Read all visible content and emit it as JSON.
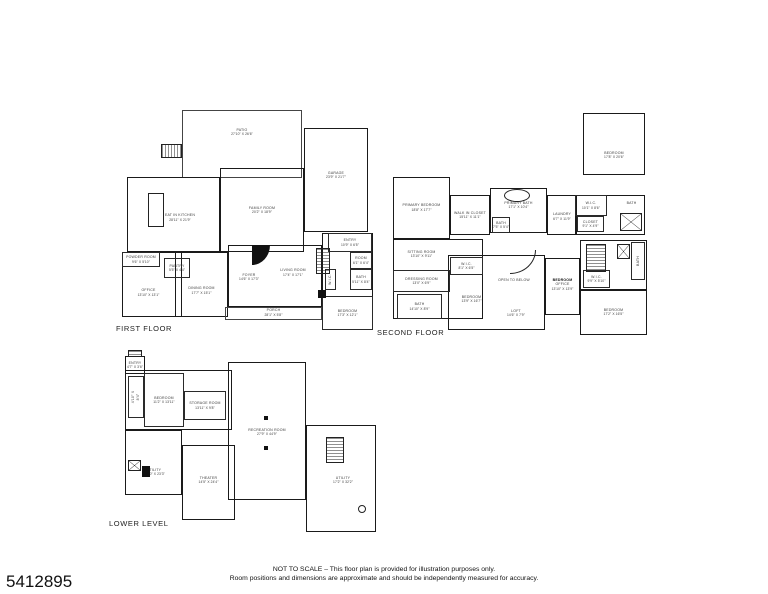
{
  "listing_id": "5412895",
  "disclaimer": {
    "line1": "NOT TO SCALE – This floor plan is provided for illustration purposes only.",
    "line2": "Room positions and dimensions are approximate and should be independently measured for accuracy."
  },
  "colors": {
    "wall": "#1a1a1a",
    "background": "#ffffff",
    "text": "#3a3a3a"
  },
  "floors": [
    {
      "name": "FIRST FLOOR",
      "outline": [
        {
          "box": [
            182,
            110,
            120,
            68
          ],
          "thin": true
        },
        {
          "box": [
            220,
            168,
            84,
            84
          ]
        },
        {
          "box": [
            304,
            128,
            64,
            104
          ]
        },
        {
          "box": [
            127,
            177,
            93,
            75
          ]
        },
        {
          "box": [
            122,
            252,
            60,
            65
          ]
        },
        {
          "box": [
            175,
            252,
            53,
            65
          ]
        },
        {
          "box": [
            228,
            245,
            94,
            62
          ]
        },
        {
          "box": [
            322,
            233,
            51,
            97
          ]
        },
        {
          "box": [
            225,
            307,
            97,
            13
          ],
          "thin": true
        }
      ],
      "rooms": [
        {
          "label": "PATIO",
          "dims": "27'10\" X 26'6\"",
          "box": [
            182,
            112,
            120,
            40
          ],
          "wall": "none"
        },
        {
          "label": "FAMILY ROOM",
          "dims": "20'2\" X 18'9\"",
          "box": [
            220,
            168,
            84,
            84
          ],
          "wall": "none"
        },
        {
          "label": "GARAGE",
          "dims": "23'9\" X 21'7\"",
          "box": [
            304,
            140,
            64,
            70
          ],
          "wall": "none"
        },
        {
          "label": "EAT IN KITCHEN",
          "dims": "28'11\" X 21'9\"",
          "box": [
            140,
            190,
            80,
            55
          ],
          "wall": "none"
        },
        {
          "label": "POWDER ROOM",
          "dims": "9'6\" X 5'10\"",
          "box": [
            122,
            252,
            38,
            15
          ],
          "wall": "thin"
        },
        {
          "label": "PANTRY",
          "dims": "5'5\" X 4'4\"",
          "box": [
            164,
            258,
            26,
            20
          ],
          "wall": "thin"
        },
        {
          "label": "OFFICE",
          "dims": "13'10\" X 13'1\"",
          "box": [
            122,
            268,
            53,
            49
          ],
          "wall": "none"
        },
        {
          "label": "DINING ROOM",
          "dims": "17'7\" X 15'1\"",
          "box": [
            175,
            268,
            53,
            45
          ],
          "wall": "none"
        },
        {
          "label": "FOYER",
          "dims": "14'6\" X 17'3\"",
          "box": [
            228,
            252,
            42,
            50
          ],
          "wall": "none"
        },
        {
          "label": "LIVING ROOM",
          "dims": "17'4\" X 17'1\"",
          "box": [
            270,
            245,
            46,
            55
          ],
          "wall": "none"
        },
        {
          "label": "PORCH",
          "dims": "28'1\" X 5'8\"",
          "box": [
            225,
            305,
            97,
            15
          ],
          "wall": "none"
        },
        {
          "label": "ENTRY",
          "dims": "10'9\" X 6'5\"",
          "box": [
            328,
            233,
            44,
            19
          ],
          "wall": "thin"
        },
        {
          "label": "ROOM",
          "dims": "6'1\" X 6'4\"",
          "box": [
            350,
            252,
            22,
            17
          ],
          "wall": "thin"
        },
        {
          "label": "BATH",
          "dims": "5'11\" X 8'4\"",
          "box": [
            350,
            269,
            22,
            21
          ],
          "wall": "thin"
        },
        {
          "id": "wic-hall",
          "label": "W.I.C.",
          "box": [
            325,
            269,
            11,
            21
          ],
          "wall": "thin",
          "vertical": true
        },
        {
          "label": "BEDROOM",
          "dims": "17'3\" X 12'1\"",
          "box": [
            322,
            296,
            51,
            34
          ],
          "wall": "thin"
        }
      ],
      "features": [
        {
          "type": "hatch-h",
          "box": [
            161,
            144,
            21,
            14
          ]
        },
        {
          "type": "box",
          "box": [
            148,
            193,
            16,
            34
          ]
        },
        {
          "type": "wedge",
          "box": [
            252,
            245,
            18,
            20
          ]
        },
        {
          "type": "hatch",
          "box": [
            316,
            248,
            14,
            26
          ]
        },
        {
          "type": "dark",
          "box": [
            318,
            290,
            8,
            8
          ]
        }
      ]
    },
    {
      "name": "SECOND FLOOR",
      "outline": [
        {
          "box": [
            393,
            177,
            57,
            62
          ]
        },
        {
          "box": [
            450,
            195,
            40,
            40
          ]
        },
        {
          "box": [
            490,
            188,
            57,
            45
          ]
        },
        {
          "box": [
            547,
            195,
            30,
            40
          ]
        },
        {
          "box": [
            583,
            113,
            62,
            62
          ]
        },
        {
          "box": [
            575,
            195,
            70,
            40
          ]
        },
        {
          "box": [
            393,
            239,
            90,
            80
          ]
        },
        {
          "box": [
            448,
            255,
            97,
            75
          ]
        },
        {
          "box": [
            545,
            258,
            35,
            57
          ]
        },
        {
          "box": [
            580,
            240,
            67,
            50
          ]
        },
        {
          "box": [
            580,
            290,
            67,
            45
          ]
        }
      ],
      "rooms": [
        {
          "label": "PRIMARY BEDROOM",
          "dims": "18'8\" X 17'7\"",
          "box": [
            393,
            180,
            57,
            55
          ],
          "wall": "none"
        },
        {
          "label": "WALK IN CLOSET",
          "dims": "15'11\" X 11'1\"",
          "box": [
            450,
            198,
            40,
            34
          ],
          "wall": "none"
        },
        {
          "label": "PRIMARY BATH",
          "dims": "17'1\" X 10'4\"",
          "box": [
            490,
            190,
            57,
            30
          ],
          "wall": "none"
        },
        {
          "id": "bath-wc",
          "label": "BATH",
          "dims": "7'5\" X 5'4\"",
          "box": [
            492,
            217,
            18,
            16
          ],
          "wall": "thin"
        },
        {
          "label": "LAUNDRY",
          "dims": "6'7\" X 11'9\"",
          "box": [
            549,
            200,
            26,
            33
          ],
          "wall": "none"
        },
        {
          "id": "wic-top-right",
          "label": "W.I.C.",
          "dims": "10'1\" X 8'6\"",
          "box": [
            575,
            195,
            32,
            21
          ],
          "wall": "thin"
        },
        {
          "label": "CLOSET",
          "dims": "9'1\" X 4'9\"",
          "box": [
            577,
            216,
            27,
            16
          ],
          "wall": "thin"
        },
        {
          "id": "bath-top-right",
          "label": "BATH",
          "box": [
            618,
            195,
            27,
            16
          ],
          "wall": "none"
        },
        {
          "id": "bedroom-top-right",
          "label": "BEDROOM",
          "dims": "17'8\" X 20'6\"",
          "box": [
            583,
            130,
            62,
            50
          ],
          "wall": "none"
        },
        {
          "label": "SITTING ROOM",
          "dims": "13'10\" X 9'11\"",
          "box": [
            393,
            241,
            57,
            26
          ],
          "wall": "none"
        },
        {
          "id": "wic-mid",
          "label": "W.I.C.",
          "dims": "8'1\" X 6'5\"",
          "box": [
            450,
            257,
            33,
            18
          ],
          "wall": "thin"
        },
        {
          "label": "DRESSING ROOM",
          "dims": "13'0\" X 6'9\"",
          "box": [
            393,
            270,
            57,
            22
          ],
          "wall": "thin"
        },
        {
          "id": "bath-bottom-left",
          "label": "BATH",
          "dims": "14'10\" X 8'9\"",
          "box": [
            397,
            294,
            45,
            25
          ],
          "wall": "thin"
        },
        {
          "id": "bedroom-center",
          "label": "BEDROOM",
          "dims": "13'9\" X 16'7\"",
          "box": [
            448,
            278,
            47,
            42
          ],
          "wall": "none"
        },
        {
          "label": "OPEN TO BELOW",
          "box": [
            490,
            268,
            48,
            25
          ],
          "wall": "none"
        },
        {
          "label": "LOFT",
          "dims": "14'6\" X 7'9\"",
          "box": [
            495,
            303,
            42,
            20
          ],
          "wall": "none"
        },
        {
          "label": "BEDROOM",
          "label2": "OFFICE",
          "dims": "13'10\" X 13'9\"",
          "bold": true,
          "id": "bedroom-office",
          "box": [
            545,
            262,
            35,
            45
          ],
          "wall": "none"
        },
        {
          "id": "bath-right-vertical",
          "label": "BATH",
          "box": [
            631,
            242,
            14,
            38
          ],
          "wall": "thin",
          "vertical": true
        },
        {
          "id": "wic-bottom-right",
          "label": "W.I.C.",
          "dims": "9'9\" X 5'10\"",
          "box": [
            583,
            270,
            27,
            18
          ],
          "wall": "thin"
        },
        {
          "id": "bedroom-bottom-right",
          "label": "BEDROOM",
          "dims": "17'2\" X 16'5\"",
          "box": [
            580,
            292,
            67,
            40
          ],
          "wall": "none"
        }
      ],
      "features": [
        {
          "type": "oval",
          "box": [
            504,
            189,
            26,
            13
          ]
        },
        {
          "type": "xbox",
          "box": [
            620,
            213,
            22,
            18
          ]
        },
        {
          "type": "hatch",
          "box": [
            586,
            244,
            20,
            28
          ]
        },
        {
          "type": "xbox",
          "box": [
            617,
            244,
            13,
            15
          ]
        },
        {
          "type": "arc",
          "box": [
            510,
            250,
            26,
            24
          ]
        }
      ]
    },
    {
      "name": "LOWER LEVEL",
      "outline": [
        {
          "box": [
            125,
            356,
            20,
            18
          ]
        },
        {
          "box": [
            125,
            370,
            107,
            60
          ]
        },
        {
          "box": [
            228,
            362,
            78,
            138
          ]
        },
        {
          "box": [
            306,
            425,
            70,
            107
          ]
        },
        {
          "box": [
            125,
            430,
            57,
            65
          ]
        },
        {
          "box": [
            182,
            445,
            53,
            75
          ]
        }
      ],
      "rooms": [
        {
          "label": "ENTRY",
          "dims": "4'7\" X 3'6\"",
          "box": [
            125,
            357,
            20,
            16
          ],
          "wall": "none"
        },
        {
          "id": "stair-hall-dims",
          "label": "4'10\" X 8'4\"",
          "box": [
            128,
            376,
            16,
            42
          ],
          "wall": "thin",
          "vertical": true
        },
        {
          "id": "bedroom-lower",
          "label": "BEDROOM",
          "dims": "11'2\" X 13'11\"",
          "box": [
            144,
            373,
            40,
            54
          ],
          "wall": "thin"
        },
        {
          "label": "STORAGE ROOM",
          "dims": "13'11\" X 9'8\"",
          "box": [
            184,
            391,
            42,
            29
          ],
          "wall": "thin"
        },
        {
          "label": "RECREATION ROOM",
          "dims": "27'9\" X 44'9\"",
          "box": [
            228,
            400,
            78,
            64
          ],
          "wall": "none"
        },
        {
          "id": "utility-left",
          "label": "UTILITY",
          "dims": "13'10\" X 23'3\"",
          "box": [
            128,
            452,
            52,
            40
          ],
          "wall": "none"
        },
        {
          "label": "THEATER",
          "dims": "14'5\" X 24'4\"",
          "box": [
            182,
            455,
            53,
            50
          ],
          "wall": "none"
        },
        {
          "id": "utility-right",
          "label": "UTILITY",
          "dims": "17'2\" X 32'2\"",
          "box": [
            312,
            455,
            62,
            50
          ],
          "wall": "none"
        }
      ],
      "features": [
        {
          "type": "hatch",
          "box": [
            128,
            350,
            14,
            7
          ]
        },
        {
          "type": "column",
          "box": [
            264,
            416,
            4,
            4
          ]
        },
        {
          "type": "column",
          "box": [
            264,
            446,
            4,
            4
          ]
        },
        {
          "type": "xbox",
          "box": [
            128,
            460,
            13,
            11
          ]
        },
        {
          "type": "dark",
          "box": [
            142,
            466,
            8,
            11
          ]
        },
        {
          "type": "hatch",
          "box": [
            326,
            437,
            18,
            26
          ]
        },
        {
          "type": "circle",
          "box": [
            358,
            505,
            8,
            8
          ]
        }
      ]
    }
  ]
}
